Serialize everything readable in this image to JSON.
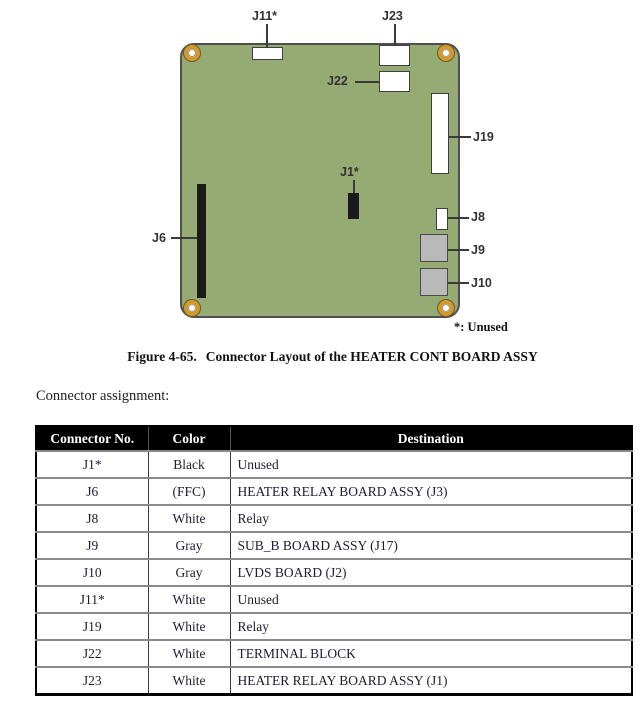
{
  "figure": {
    "caption_label": "Figure 4-65.",
    "caption_text": "Connector Layout of the HEATER CONT BOARD ASSY"
  },
  "diagram": {
    "unused_note": "*: Unused",
    "labels": {
      "j1": "J1*",
      "j6": "J6",
      "j8": "J8",
      "j9": "J9",
      "j10": "J10",
      "j11": "J11*",
      "j19": "J19",
      "j22": "J22",
      "j23": "J23"
    },
    "colors": {
      "board_green": "#96aa73",
      "hole_ring_orange": "#d29a2a",
      "connector_white": "#ffffff",
      "connector_gray": "#b9b9b9",
      "connector_black": "#1a1a1a"
    }
  },
  "section": {
    "intro": "Connector assignment:"
  },
  "table": {
    "headers": [
      "Connector No.",
      "Color",
      "Destination"
    ],
    "rows": [
      {
        "connector": "J1*",
        "color": "Black",
        "destination": "Unused"
      },
      {
        "connector": "J6",
        "color": "(FFC)",
        "destination": "HEATER RELAY BOARD ASSY (J3)"
      },
      {
        "connector": "J8",
        "color": "White",
        "destination": "Relay"
      },
      {
        "connector": "J9",
        "color": "Gray",
        "destination": "SUB_B BOARD ASSY (J17)"
      },
      {
        "connector": "J10",
        "color": "Gray",
        "destination": "LVDS BOARD (J2)"
      },
      {
        "connector": "J11*",
        "color": "White",
        "destination": "Unused"
      },
      {
        "connector": "J19",
        "color": "White",
        "destination": "Relay"
      },
      {
        "connector": "J22",
        "color": "White",
        "destination": "TERMINAL BLOCK"
      },
      {
        "connector": "J23",
        "color": "White",
        "destination": "HEATER RELAY BOARD ASSY (J1)"
      }
    ]
  }
}
